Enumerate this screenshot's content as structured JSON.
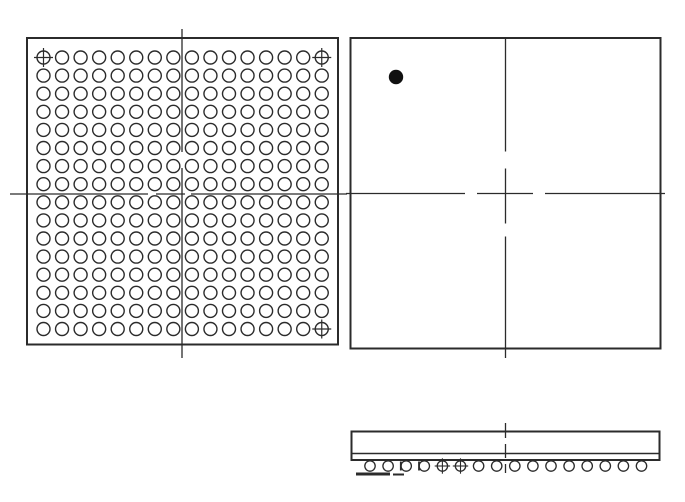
{
  "page": {
    "description": "BGA integrated-circuit package outline drawing with three views: ball-grid bottom view, top view with pin-1 indicator, and side profile view",
    "background_color": "#ffffff",
    "width": 685,
    "height": 502
  },
  "colors": {
    "line": "#2b2b2b",
    "pin1_dot": "#111111"
  },
  "views": {
    "bottom_view": {
      "label": "package-bottom-view-ball-grid",
      "frame": {
        "x": 27,
        "y": 38,
        "width": 311,
        "height": 306.5
      },
      "ball_grid": {
        "rows": 16,
        "cols": 16,
        "x0": 43.5,
        "y0": 57.5,
        "dx": 18.55,
        "dy": 18.1,
        "ball_radius": 6.5,
        "ball_stroke_width": 1.4
      },
      "total_balls": 256,
      "fiducial_balls": [
        {
          "row": 1,
          "col": 1,
          "corner": "top-left"
        },
        {
          "row": 1,
          "col": 16,
          "corner": "top-right"
        },
        {
          "row": 16,
          "col": 16,
          "corner": "bottom-right"
        }
      ]
    },
    "top_view": {
      "label": "package-top-view",
      "frame": {
        "x": 350.5,
        "y": 38,
        "width": 310,
        "height": 310.5
      },
      "pin1_marker": {
        "cx": 396,
        "cy": 77,
        "radius": 7.2
      }
    },
    "side_view": {
      "label": "package-side-view",
      "body": {
        "x": 351.5,
        "y": 431.5,
        "width": 308,
        "height": 28.5
      },
      "substrate_line_y": 453.5,
      "balls": {
        "count": 16,
        "x0": 370,
        "dx": 18.1,
        "cy": 466,
        "radius": 5.2,
        "ball_stroke_width": 1.3
      },
      "crosshair_balls": [
        5,
        6
      ],
      "artifact_marks": [
        {
          "x1": 356,
          "y1": 474,
          "x2": 390,
          "y2": 474,
          "stroke_width": 3
        },
        {
          "x1": 393,
          "y1": 474.5,
          "x2": 404,
          "y2": 474.5,
          "stroke_width": 2
        },
        {
          "x1": 400.8,
          "y1": 461.5,
          "x2": 400.8,
          "y2": 470.5,
          "stroke_width": 1.8
        },
        {
          "x1": 419,
          "y1": 461.5,
          "x2": 419,
          "y2": 470.5,
          "stroke_width": 1.8
        }
      ]
    }
  }
}
